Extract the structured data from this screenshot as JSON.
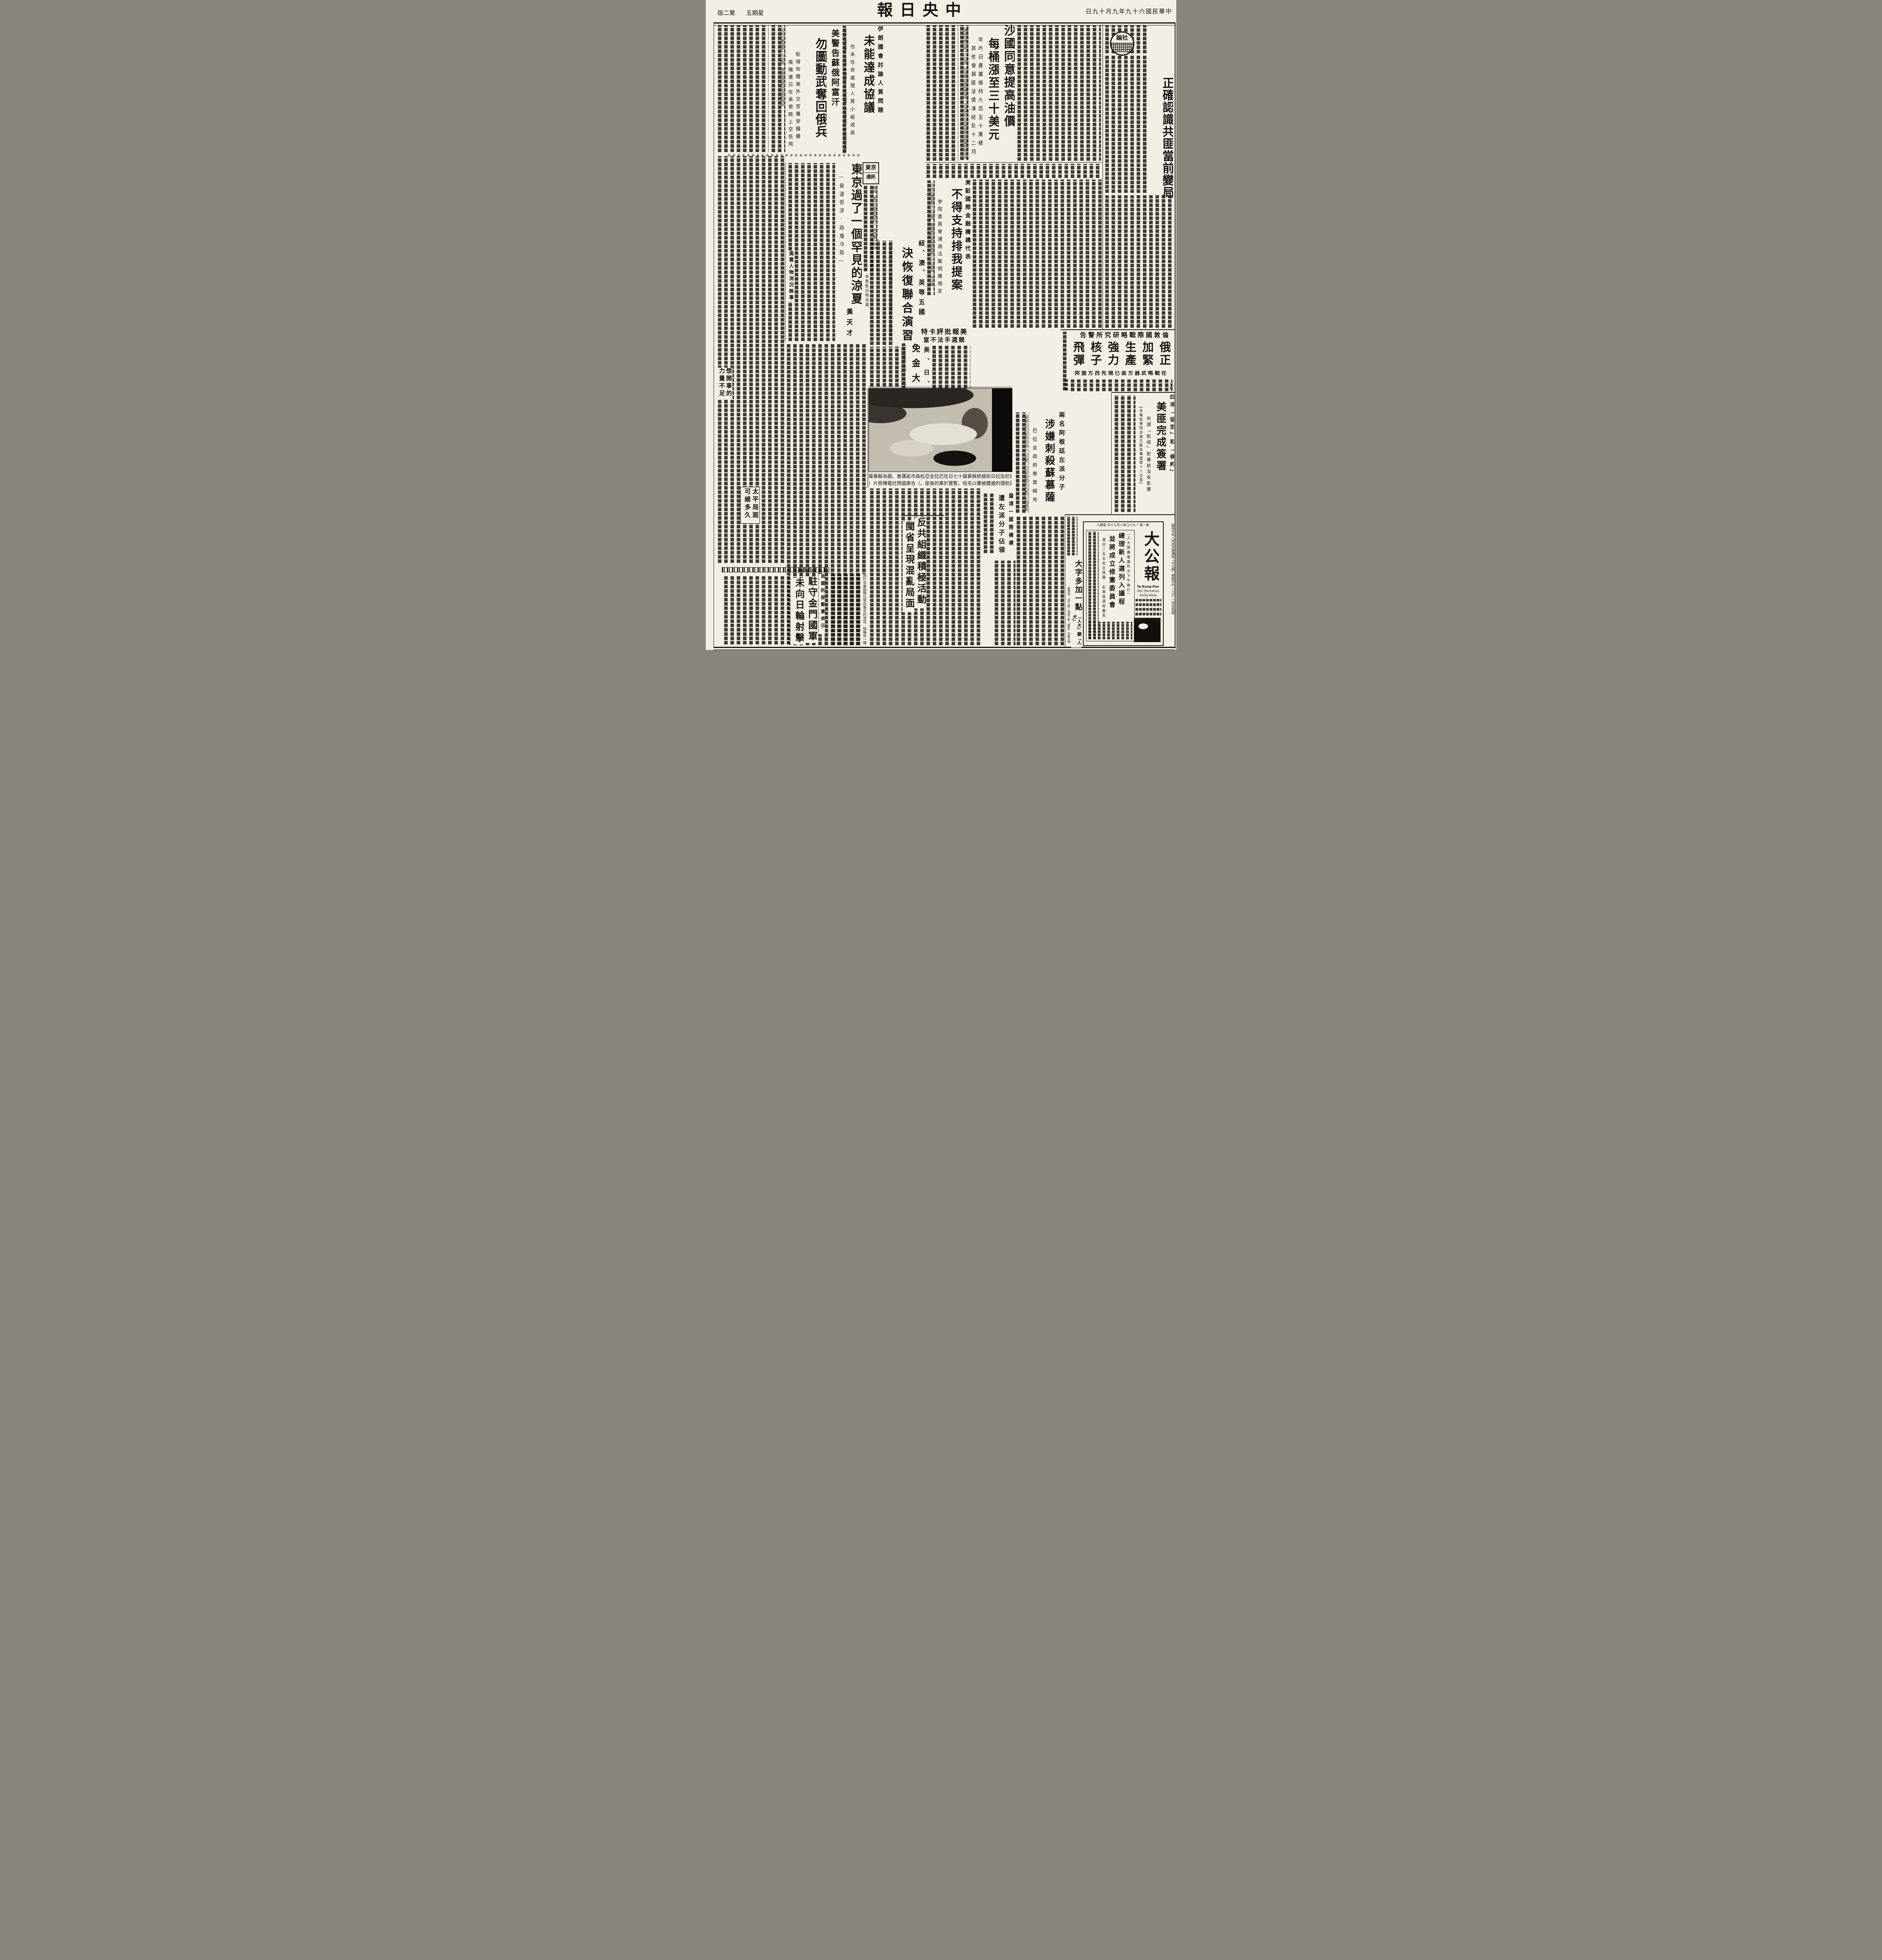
{
  "page": {
    "masthead": "中央日報",
    "date": "中華民國六十九年九月十九日",
    "weekday": "星期五",
    "page_label": "第二版",
    "separator_stars": "✳✳✳✳✳✳✳✳✳✳✳✳✳✳✳✳✳✳✳✳✳✳✳✳✳✳✳✳"
  },
  "editorial": {
    "logo": "社論",
    "headline": "正確認識共匪當前變局"
  },
  "oil": {
    "headline_1": "沙國同意提高油價",
    "headline_2": "每桶漲至三十美元",
    "subhead_1": "年內日產量維持九百五十萬桶",
    "subhead_2": "其他會員國油價凍結到十二月",
    "lead": "〔路透社維也納十八日電〕石油輸出國組織宣布，沙烏地阿拉伯將按照該組織昨晚達成的一項協議"
  },
  "us_warning": {
    "kicker": "美警告蘇俄阿富汗",
    "headline": "勿圖動武奪回俄兵",
    "subhead_1": "駐喀布爾美外交官備受騷擾",
    "subhead_2": "俄機連日在美使館上空低飛",
    "lead": "〔法新社華盛頓十六日電〕據美國國務院高級官員說"
  },
  "iran": {
    "kicker": "伊朗國會討論人質問題",
    "headline": "未能達成協議",
    "subhead": "也未任命處理人質小組成員",
    "lead": "〔法新社德黑蘭十八日電〕伊朗國會今天延緩組織一個有關美國人質的特別委員會"
  },
  "tokyo": {
    "logo_line1": "東京",
    "logo_line2": "通訊",
    "headline": "東京過了一個罕見的涼夏",
    "subhead": "—氣溫低涼·政壇冷寂—",
    "byline": "本報駐日特派員",
    "byline_name": "黃天才",
    "crosshead_1": "風雲人物消沉無事",
    "crosshead_2": "想開事的力量不足",
    "crosshead_3": "太平局面可維多久",
    "lead": "東京，夏天已經是過去了，時序轉入秋涼"
  },
  "imf": {
    "kicker": "美駐國際金融機構代表",
    "headline": "不得支持排我提案",
    "subhead": "參院委員會通過法案明確規定",
    "lead": "〔中央社華盛頓十七日電〕美國參院撥款委員會十六日通過一項法案"
  },
  "exercise": {
    "kicker": "紐、澳、英等五國",
    "headline": "決恢復聯合演習",
    "lead": "〔中央社堪培拉十八日路透電〕澳洲總理佛瑞塞今天告訴國會"
  },
  "carter": {
    "kicker": "美報批評卡特",
    "headline": "競選手法不當"
  },
  "kim": {
    "kicker": "美、日、澳促韓",
    "headline": "免金大中死刑",
    "lead": "〔合衆國際社漢城十八日電〕美國、日本和澳洲今天開始對韓國施以壓力，要求免除不滿分子金大中的死刑。"
  },
  "missiles": {
    "kicker": "倫敦國際戰略研究所警告",
    "headline": "俄正加緊生產強力核子飛彈",
    "subhead": "在戰略武器方面已領先西方盟邦",
    "lead": "〔美聯社倫敦十八日電〕"
  },
  "us_prc": {
    "kicker": "四項「協定」和「條約」",
    "headline": "美匪完成簽署",
    "subhead": "所謂「航協」對華航沒有影響",
    "byline": "【本報駐美特派員王嗣佑華盛頓十八日電】"
  },
  "somoza": {
    "kicker": "兩名阿根廷左派分子",
    "headline": "涉嫌刺殺蘇慕薩",
    "subhead": "巴拉圭政府懸賞緝兇",
    "lead": "〔美聯社巴拉圭亞松森十八日電〕巴拉圭當局今天進行大規模搜捕行動"
  },
  "salvador": {
    "kicker": "薩境一國際機構",
    "headline": "遭左派分子佔領"
  },
  "fujian": {
    "headline_1": "反共組織積極活動",
    "headline_2": "閩省呈現混亂局面"
  },
  "kinmen": {
    "kicker": "我國防部鄭重表示",
    "headline_1": "駐守金門國軍",
    "headline_2": "未向日輪射擊",
    "lead": "對於合衆國際社發自東京的消息，指稱有一艘駛往廈門港的日本貨輪遭到駐守金門國軍部隊槍擊一事，國防部官員堅稱「並無此事」。"
  },
  "photo": {
    "caption_1": "流亡的尼加拉瓜前總統蘇慕薩十七日在巴拉圭亞松森市區遇害。圖為蘇慕薩",
    "caption_2": "與其助理的遺體被覆以毛毯，暫置於車的後座。（合衆國際社電傳照片）"
  },
  "takungpao": {
    "outer_caption": "圖為今年八月卅日香港匪「大公報」標題中的「人犬」二字至為明顯。",
    "left_headline_1": "大字多加一點",
    "left_headline_2": "「人大」變「人犬」",
    "note": "他僅說，「四人幫」造成了對「國家」的極大損害",
    "clip_topline": "第一張 一九八〇年八月三十日 星期六",
    "name": "大公報",
    "latin_1": "Ta-Kung-Pao",
    "latin_2": "342 Hennessy Road",
    "latin_3": "Hong Kong",
    "clip_kicker": "（人大預備會議昨天下午舉行）",
    "clip_headline_1": "總理新人選列入議程",
    "clip_headline_2": "並將成立修憲委員會",
    "clip_subhead": "選出二五五名主席團 彭真當選秘書長"
  }
}
